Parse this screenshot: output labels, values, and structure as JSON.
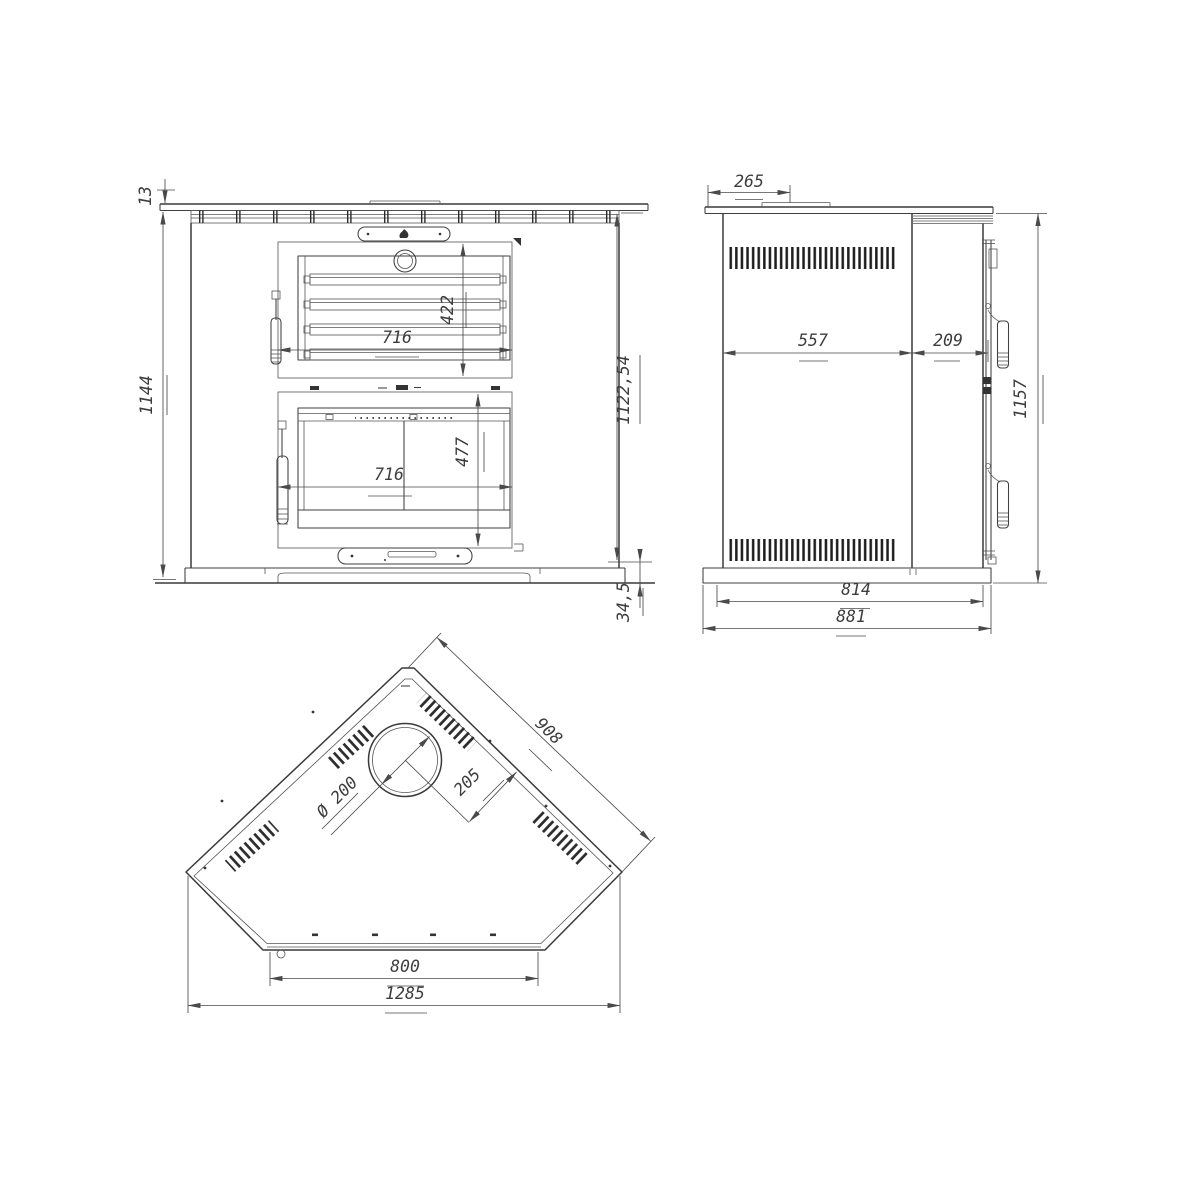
{
  "views": {
    "front": {
      "dims": {
        "top_plate_thickness": "13",
        "overall_height": "1144",
        "oven_opening_height": "422",
        "oven_opening_width": "716",
        "firebox_opening_width": "716",
        "firebox_opening_height": "477",
        "body_height": "1122,54",
        "base_height": "34,5"
      }
    },
    "side": {
      "dims": {
        "top_offset": "265",
        "body_depth": "557",
        "door_section_depth": "209",
        "overall_height": "1157",
        "base_depth": "814",
        "overall_depth": "881"
      }
    },
    "top": {
      "dims": {
        "rear_panel_length": "908",
        "flue_edge_distance": "205",
        "flue_diameter": "Ø 200",
        "front_panel_width": "800",
        "overall_width": "1285"
      }
    }
  }
}
